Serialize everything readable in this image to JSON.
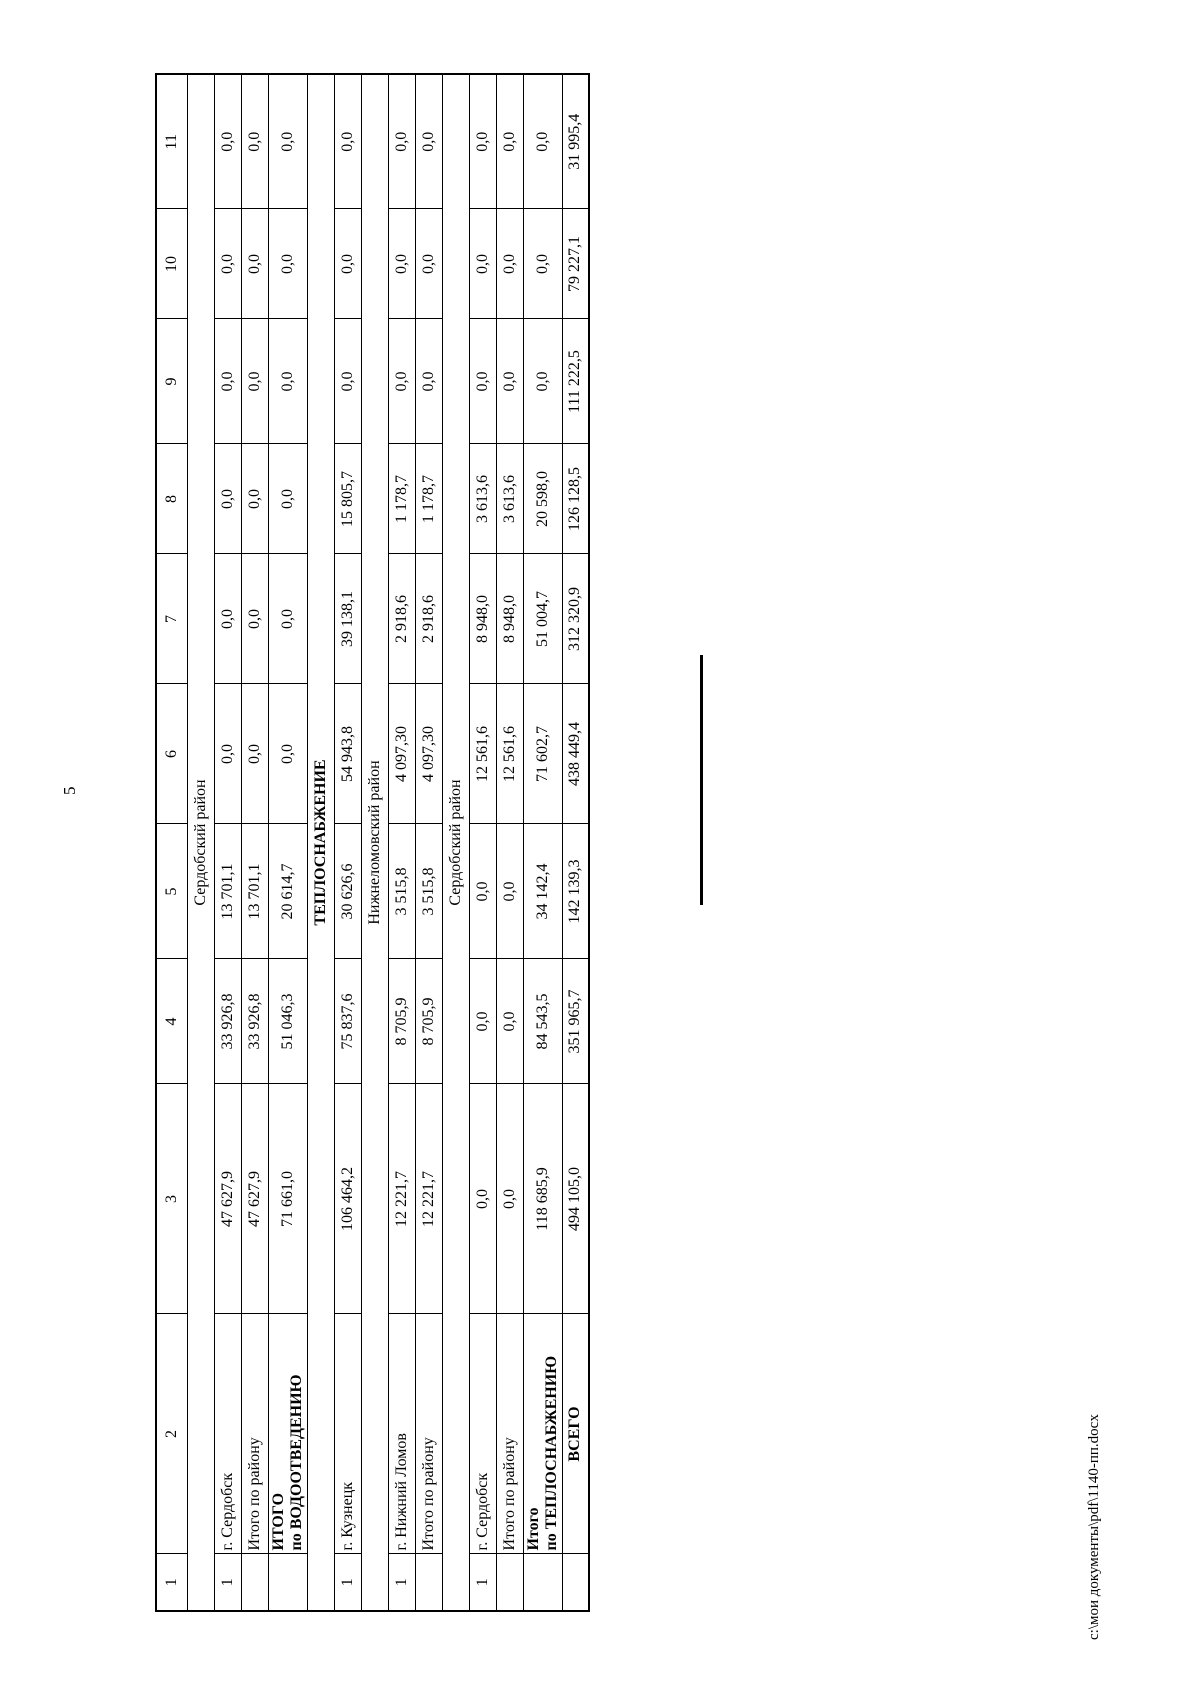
{
  "page": {
    "number": "5",
    "footer_path": "с:\\мои документы\\pdf\\1140-пп.docx"
  },
  "table": {
    "header": [
      "1",
      "2",
      "3",
      "4",
      "5",
      "6",
      "7",
      "8",
      "9",
      "10",
      "11"
    ],
    "rows": [
      {
        "type": "section",
        "label": "Сердобский район",
        "bold": false
      },
      {
        "type": "data",
        "num": "1",
        "name_lines": [
          "г. Сердобск"
        ],
        "bold": false,
        "center": false,
        "values": [
          "47 627,9",
          "33 926,8",
          "13 701,1",
          "0,0",
          "0,0",
          "0,0",
          "0,0",
          "0,0",
          "0,0"
        ]
      },
      {
        "type": "data",
        "num": "",
        "name_lines": [
          "Итого по району"
        ],
        "bold": false,
        "center": false,
        "values": [
          "47 627,9",
          "33 926,8",
          "13 701,1",
          "0,0",
          "0,0",
          "0,0",
          "0,0",
          "0,0",
          "0,0"
        ]
      },
      {
        "type": "data",
        "num": "",
        "name_lines": [
          "ИТОГО",
          "по ВОДООТВЕДЕНИЮ"
        ],
        "bold": true,
        "center": false,
        "values": [
          "71 661,0",
          "51 046,3",
          "20 614,7",
          "0,0",
          "0,0",
          "0,0",
          "0,0",
          "0,0",
          "0,0"
        ]
      },
      {
        "type": "section",
        "label": "ТЕПЛОСНАБЖЕНИЕ",
        "bold": true
      },
      {
        "type": "data",
        "num": "1",
        "name_lines": [
          "г. Кузнецк"
        ],
        "bold": false,
        "center": false,
        "values": [
          "106 464,2",
          "75 837,6",
          "30 626,6",
          "54 943,8",
          "39 138,1",
          "15 805,7",
          "0,0",
          "0,0",
          "0,0"
        ]
      },
      {
        "type": "section",
        "label": "Нижнеломовский район",
        "bold": false
      },
      {
        "type": "data",
        "num": "1",
        "name_lines": [
          "г. Нижний Ломов"
        ],
        "bold": false,
        "center": false,
        "values": [
          "12 221,7",
          "8 705,9",
          "3 515,8",
          "4 097,30",
          "2 918,6",
          "1 178,7",
          "0,0",
          "0,0",
          "0,0"
        ]
      },
      {
        "type": "data",
        "num": "",
        "name_lines": [
          "Итого по району"
        ],
        "bold": false,
        "center": false,
        "values": [
          "12 221,7",
          "8 705,9",
          "3 515,8",
          "4 097,30",
          "2 918,6",
          "1 178,7",
          "0,0",
          "0,0",
          "0,0"
        ]
      },
      {
        "type": "section",
        "label": "Сердобский район",
        "bold": false
      },
      {
        "type": "data",
        "num": "1",
        "name_lines": [
          "г. Сердобск"
        ],
        "bold": false,
        "center": false,
        "values": [
          "0,0",
          "0,0",
          "0,0",
          "12 561,6",
          "8 948,0",
          "3 613,6",
          "0,0",
          "0,0",
          "0,0"
        ]
      },
      {
        "type": "data",
        "num": "",
        "name_lines": [
          "Итого по району"
        ],
        "bold": false,
        "center": false,
        "values": [
          "0,0",
          "0,0",
          "0,0",
          "12 561,6",
          "8 948,0",
          "3 613,6",
          "0,0",
          "0,0",
          "0,0"
        ]
      },
      {
        "type": "data",
        "num": "",
        "name_lines": [
          "Итого",
          "по ТЕПЛОСНАБЖЕНИЮ"
        ],
        "bold": true,
        "center": false,
        "values": [
          "118 685,9",
          "84 543,5",
          "34 142,4",
          "71 602,7",
          "51 004,7",
          "20 598,0",
          "0,0",
          "0,0",
          "0,0"
        ]
      },
      {
        "type": "data",
        "num": "",
        "name_lines": [
          "ВСЕГО"
        ],
        "bold": true,
        "center": true,
        "values": [
          "494 105,0",
          "351 965,7",
          "142 139,3",
          "438 449,4",
          "312 320,9",
          "126 128,5",
          "111 222,5",
          "79 227,1",
          "31 995,4"
        ]
      }
    ]
  }
}
